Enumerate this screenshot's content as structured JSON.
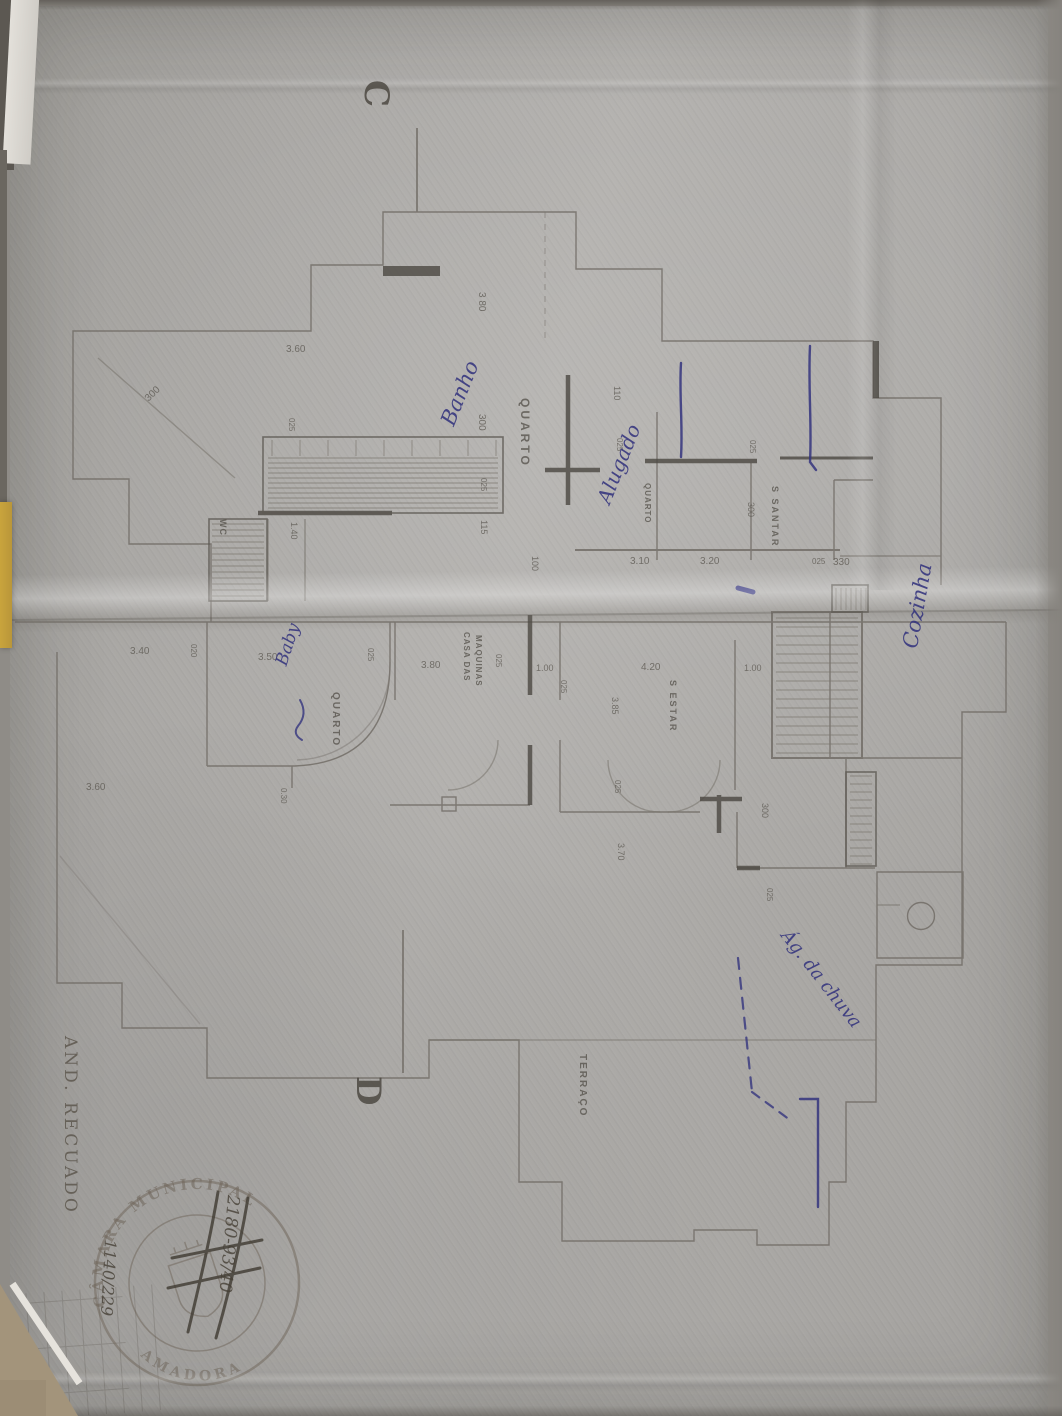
{
  "document": {
    "type_note": "photographed architectural floor plan",
    "side_title": "AND. RECUADO",
    "section_markers": [
      {
        "t": "C",
        "x": 396,
        "y": 80,
        "r": 90,
        "s": 34
      },
      {
        "t": "D",
        "x": 388,
        "y": 1076,
        "r": 90,
        "s": 34
      }
    ],
    "room_labels": [
      {
        "t": "QUARTO",
        "x": 532,
        "y": 398,
        "r": 90,
        "s": 12,
        "ls": 3
      },
      {
        "t": "QUARTO",
        "x": 652,
        "y": 483,
        "r": 90,
        "s": 8,
        "ls": 1
      },
      {
        "t": "S SANTAR",
        "x": 780,
        "y": 486,
        "r": 90,
        "s": 9,
        "ls": 2
      },
      {
        "t": "WC",
        "x": 228,
        "y": 519,
        "r": 90,
        "s": 9,
        "ls": 1
      },
      {
        "t": "CASA DAS",
        "x": 471,
        "y": 632,
        "r": 90,
        "s": 8,
        "ls": 1
      },
      {
        "t": "MAQUINAS",
        "x": 483,
        "y": 635,
        "r": 90,
        "s": 8,
        "ls": 1
      },
      {
        "t": "S ESTAR",
        "x": 678,
        "y": 680,
        "r": 90,
        "s": 9,
        "ls": 2
      },
      {
        "t": "QUARTO",
        "x": 341,
        "y": 692,
        "r": 90,
        "s": 10,
        "ls": 2
      },
      {
        "t": "TERRAÇO",
        "x": 588,
        "y": 1054,
        "r": 90,
        "s": 10,
        "ls": 2
      }
    ],
    "dimension_labels": [
      {
        "t": "3 80",
        "x": 487,
        "y": 292,
        "r": 90,
        "s": 10
      },
      {
        "t": "300",
        "x": 487,
        "y": 414,
        "r": 90,
        "s": 10
      },
      {
        "t": "025",
        "x": 488,
        "y": 478,
        "r": 90,
        "s": 8
      },
      {
        "t": "115",
        "x": 489,
        "y": 520,
        "r": 90,
        "s": 9
      },
      {
        "t": "100",
        "x": 540,
        "y": 556,
        "r": 90,
        "s": 9
      },
      {
        "t": "3.60",
        "x": 286,
        "y": 344,
        "r": 0,
        "s": 10
      },
      {
        "t": "025",
        "x": 296,
        "y": 418,
        "r": 90,
        "s": 8
      },
      {
        "t": "1.40",
        "x": 299,
        "y": 522,
        "r": 90,
        "s": 9
      },
      {
        "t": "300",
        "x": 143,
        "y": 396,
        "r": -44,
        "s": 10
      },
      {
        "t": "110",
        "x": 622,
        "y": 386,
        "r": 90,
        "s": 9
      },
      {
        "t": "025",
        "x": 624,
        "y": 438,
        "r": 90,
        "s": 8
      },
      {
        "t": "3.10",
        "x": 630,
        "y": 556,
        "r": 0,
        "s": 10
      },
      {
        "t": "3.20",
        "x": 700,
        "y": 556,
        "r": 0,
        "s": 10
      },
      {
        "t": "025",
        "x": 757,
        "y": 440,
        "r": 90,
        "s": 8
      },
      {
        "t": "300",
        "x": 756,
        "y": 502,
        "r": 90,
        "s": 9
      },
      {
        "t": "025",
        "x": 812,
        "y": 557,
        "r": 0,
        "s": 8
      },
      {
        "t": "330",
        "x": 833,
        "y": 557,
        "r": 0,
        "s": 10
      },
      {
        "t": "3.40",
        "x": 130,
        "y": 646,
        "r": 0,
        "s": 10
      },
      {
        "t": "020",
        "x": 198,
        "y": 644,
        "r": 90,
        "s": 8
      },
      {
        "t": "3.50",
        "x": 258,
        "y": 652,
        "r": 0,
        "s": 10
      },
      {
        "t": "025",
        "x": 375,
        "y": 648,
        "r": 90,
        "s": 8
      },
      {
        "t": "3.80",
        "x": 421,
        "y": 660,
        "r": 0,
        "s": 10
      },
      {
        "t": "025",
        "x": 503,
        "y": 654,
        "r": 90,
        "s": 8
      },
      {
        "t": "1.00",
        "x": 536,
        "y": 663,
        "r": 0,
        "s": 9
      },
      {
        "t": "025",
        "x": 568,
        "y": 680,
        "r": 90,
        "s": 8
      },
      {
        "t": "4.20",
        "x": 641,
        "y": 662,
        "r": 0,
        "s": 10
      },
      {
        "t": "1.00",
        "x": 744,
        "y": 663,
        "r": 0,
        "s": 9
      },
      {
        "t": "3.85",
        "x": 620,
        "y": 697,
        "r": 90,
        "s": 9
      },
      {
        "t": "025",
        "x": 622,
        "y": 780,
        "r": 90,
        "s": 8
      },
      {
        "t": "3.70",
        "x": 626,
        "y": 843,
        "r": 90,
        "s": 9
      },
      {
        "t": "0.30",
        "x": 288,
        "y": 788,
        "r": 90,
        "s": 8
      },
      {
        "t": "3.60",
        "x": 86,
        "y": 782,
        "r": 0,
        "s": 10
      },
      {
        "t": "300",
        "x": 770,
        "y": 803,
        "r": 90,
        "s": 9
      },
      {
        "t": "025",
        "x": 774,
        "y": 888,
        "r": 90,
        "s": 8
      }
    ],
    "handwritten_notes": [
      {
        "t": "Banho",
        "x": 436,
        "y": 420,
        "r": -68,
        "s": 21
      },
      {
        "t": "Alugado",
        "x": 592,
        "y": 498,
        "r": -68,
        "s": 20
      },
      {
        "t": "Cozinha",
        "x": 898,
        "y": 646,
        "r": -80,
        "s": 21
      },
      {
        "t": "Ág. da chuva",
        "x": 793,
        "y": 926,
        "r": 52,
        "s": 18
      },
      {
        "t": "Baby",
        "x": 272,
        "y": 662,
        "r": -72,
        "s": 17
      }
    ],
    "stamp": {
      "top_text": "CÂMARA MUNICIPAL",
      "bottom_text": "AMADORA",
      "note_right": "2180-93/40",
      "note_left": "1140/229"
    },
    "ink_color": "#34347e",
    "pencil_color": "#5f5a53"
  }
}
